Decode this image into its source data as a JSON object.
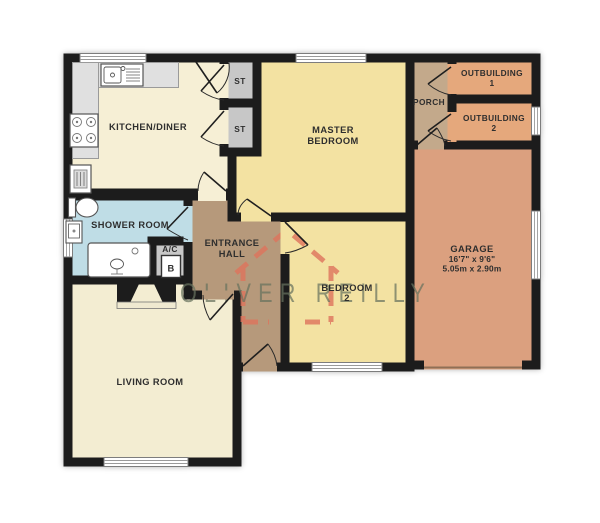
{
  "watermark": {
    "brand": "OLIVER REILLY"
  },
  "labels": {
    "kitchen": "KITCHEN/DINER",
    "master_line1": "MASTER",
    "master_line2": "BEDROOM",
    "porch": "PORCH",
    "outbuilding1_line1": "OUTBUILDING",
    "outbuilding1_line2": "1",
    "outbuilding2_line1": "OUTBUILDING",
    "outbuilding2_line2": "2",
    "garage": "GARAGE",
    "garage_imperial": "16'7\" x 9'6\"",
    "garage_metric": "5.05m x 2.90m",
    "shower": "SHOWER ROOM",
    "ac": "A/C",
    "boiler": "B",
    "hall_line1": "ENTRANCE",
    "hall_line2": "HALL",
    "bedroom2_line1": "BEDROOM",
    "bedroom2_line2": "2",
    "living": "LIVING ROOM",
    "st1": "ST",
    "st2": "ST"
  },
  "colors": {
    "wall": "#1c1c1c",
    "kitchen": "#f6efd5",
    "living": "#f3edd2",
    "bedroom": "#f3e2a2",
    "shower": "#bfdde6",
    "hall": "#b6997b",
    "porch": "#c3a98b",
    "outbuilding": "#e5a87c",
    "garage": "#dba07f",
    "closet": "#c7c7c7",
    "garage_door": "#8f6f56",
    "watermark_text": "#68735f",
    "logo": "#df745d"
  }
}
